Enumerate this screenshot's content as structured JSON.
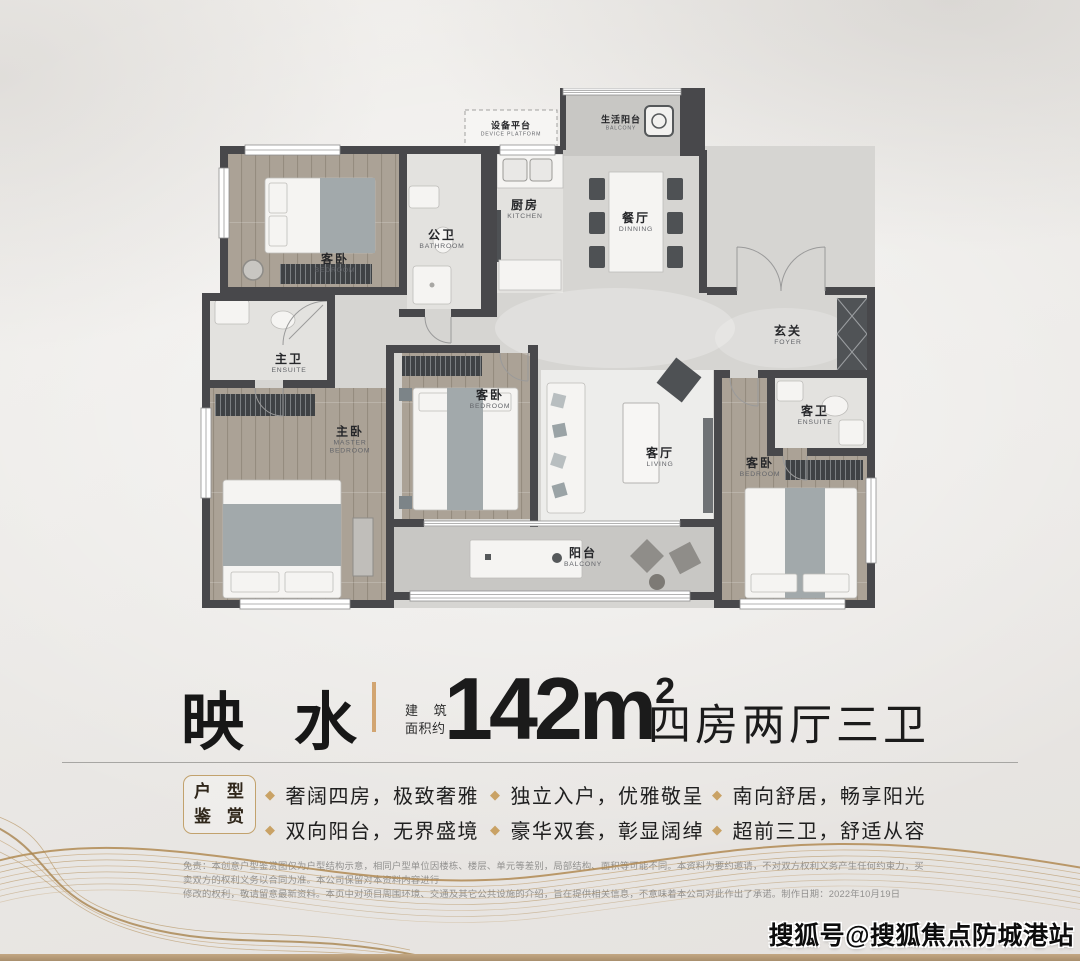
{
  "plan": {
    "rooms": [
      {
        "cn": "设备平台",
        "en": "DEVICE PLATFORM"
      },
      {
        "cn": "生活阳台",
        "en": "BALCONY"
      },
      {
        "cn": "客卧",
        "en": "BEDROOM"
      },
      {
        "cn": "公卫",
        "en": "BATHROOM"
      },
      {
        "cn": "厨房",
        "en": "KITCHEN"
      },
      {
        "cn": "餐厅",
        "en": "DINNING"
      },
      {
        "cn": "玄关",
        "en": "FOYER"
      },
      {
        "cn": "主卫",
        "en": "ENSUITE"
      },
      {
        "cn": "主卧",
        "en": "MASTER BEDROOM"
      },
      {
        "cn": "客卧",
        "en": "BEDROOM"
      },
      {
        "cn": "客厅",
        "en": "LIVING"
      },
      {
        "cn": "客卫",
        "en": "ENSUITE"
      },
      {
        "cn": "客卧",
        "en": "BEDROOM"
      },
      {
        "cn": "阳台",
        "en": "BALCONY"
      }
    ]
  },
  "title": {
    "name": "映 水",
    "area_prefix_line1": "建 筑",
    "area_prefix_line2": "面积约",
    "area_value": "142m",
    "area_sup": "2",
    "layout_desc": "四房两厅三卫"
  },
  "features": {
    "badge_line1": "户 型",
    "badge_line2": "鉴 赏",
    "items": [
      "奢阔四房，极致奢雅",
      "双向阳台，无界盛境",
      "独立入户，优雅敬呈",
      "豪华双套，彰显阔绰",
      "南向舒居，畅享阳光",
      "超前三卫，舒适从容"
    ]
  },
  "disclaimer": {
    "line1": "免责：本创意户型鉴赏图仅为户型结构示意，相同户型单位因楼栋、楼层、单元等差别，局部结构、面积等可能不同。本资料为要约邀请，不对双方权利义务产生任何约束力，买卖双方的权利义务以合同为准。本公司保留对本资料内容进行",
    "line2": "修改的权利，敬请留意最新资料。本页中对项目周围环境、交通及其它公共设施的介绍，旨在提供相关信息，不意味着本公司对此作出了承诺。制作日期：2022年10月19日"
  },
  "watermark": "搜狐号@搜狐焦点防城港站",
  "colors": {
    "accent_gold": "#c9a265",
    "wall": "#48484b",
    "text_dark": "#1b1b1b"
  }
}
